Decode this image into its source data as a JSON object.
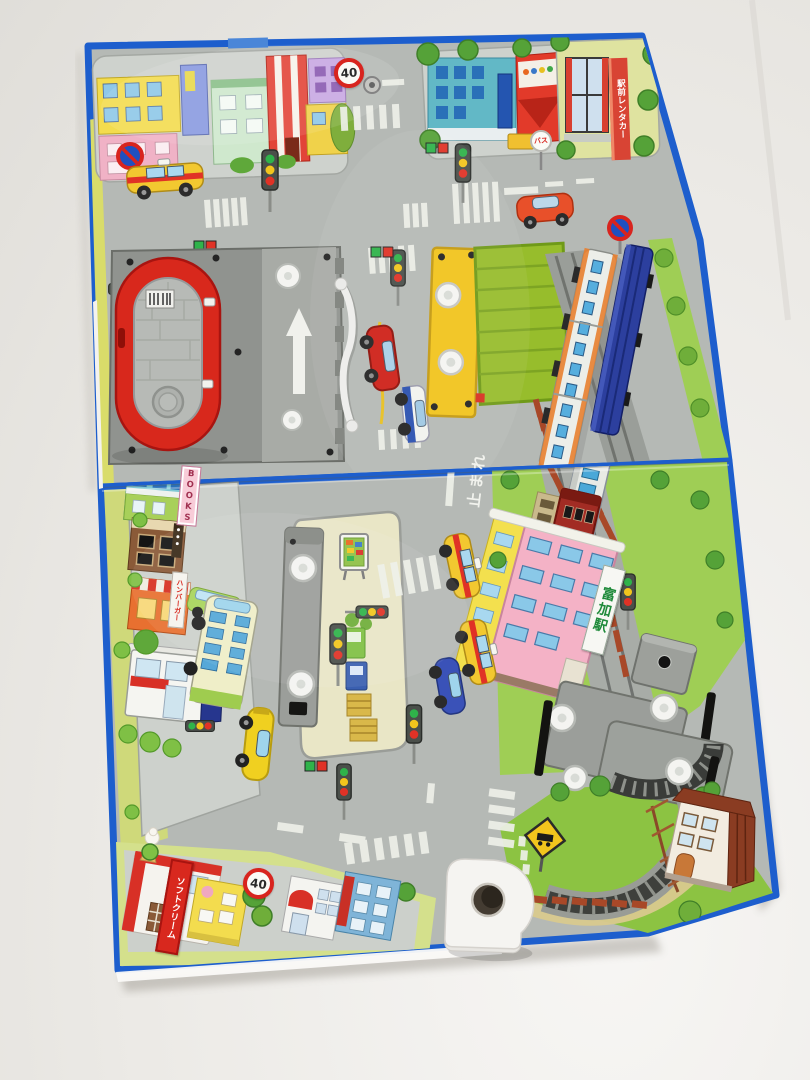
{
  "scene": {
    "type": "photograph",
    "subject": "Open pop-up play book: Japanese toy town street map with railway, toy vehicles and movable gray plastic track parts",
    "orientation": "book lying open on a white table, photographed at a slight angle"
  },
  "palette": {
    "backdrop": "#eceae6",
    "board_edge_blue": "#1d5ecd",
    "road_gray": "#b5b9b5",
    "sidewalk_gray": "#ced2cd",
    "grass_green": "#9fce55",
    "grass_dark_green": "#8cc342",
    "plastic_gray": "#9b9e9a",
    "toy_red": "#d8281c",
    "toy_yellow": "#f2c41c",
    "container_green": "#97bd2c",
    "train_blue": "#2c3f9e",
    "taxi_yellow": "#f2c830",
    "station_pink": "#f4b2c6"
  },
  "signs": {
    "speed_limit_top": "40",
    "speed_limit_bottom": "40",
    "stop_road_marking": "止まれ",
    "bookstore_sign": "BOOKS",
    "station_sign": "富加駅",
    "bus_stop_sign": "バス",
    "ice_cream_sign": "ソフトクリーム",
    "rent_a_car_sign": "駅前レンタカー",
    "burger_sign": "ハンバーガー"
  }
}
